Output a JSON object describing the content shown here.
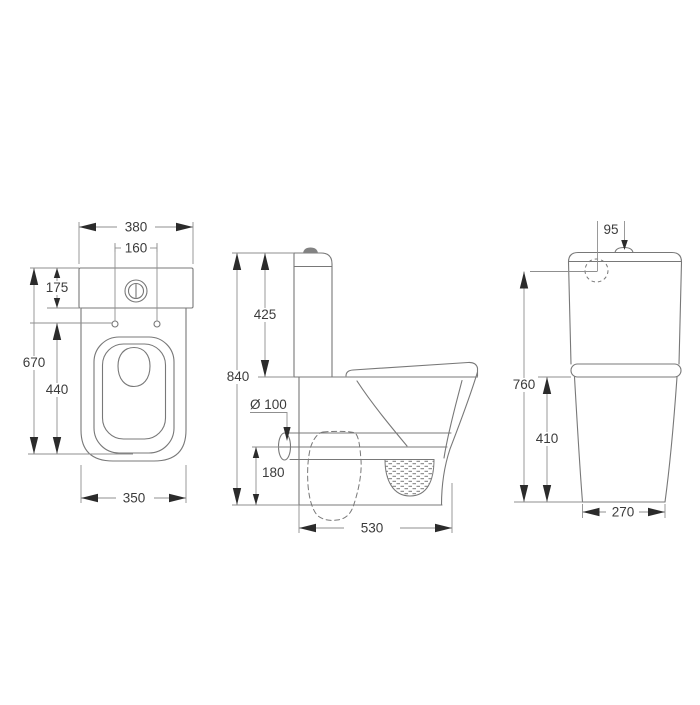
{
  "views": {
    "top": {
      "dims": {
        "overall_width": "380",
        "hinge_spacing": "160",
        "tank_depth": "175",
        "overall_length": "670",
        "seat_length": "440",
        "base_length": "350"
      }
    },
    "side": {
      "dims": {
        "overall_height": "840",
        "tank_height": "425",
        "outlet_diameter": "Ø 100",
        "outlet_height": "180",
        "overall_depth": "530"
      }
    },
    "rear": {
      "dims": {
        "inlet_offset": "95",
        "inlet_height": "760",
        "bowl_height": "410",
        "base_width": "270"
      }
    }
  },
  "colors": {
    "line": "#787878",
    "dim": "#8f8f8f",
    "arrow": "#2b2b2b",
    "text": "#3c3c3c",
    "background": "#ffffff"
  }
}
